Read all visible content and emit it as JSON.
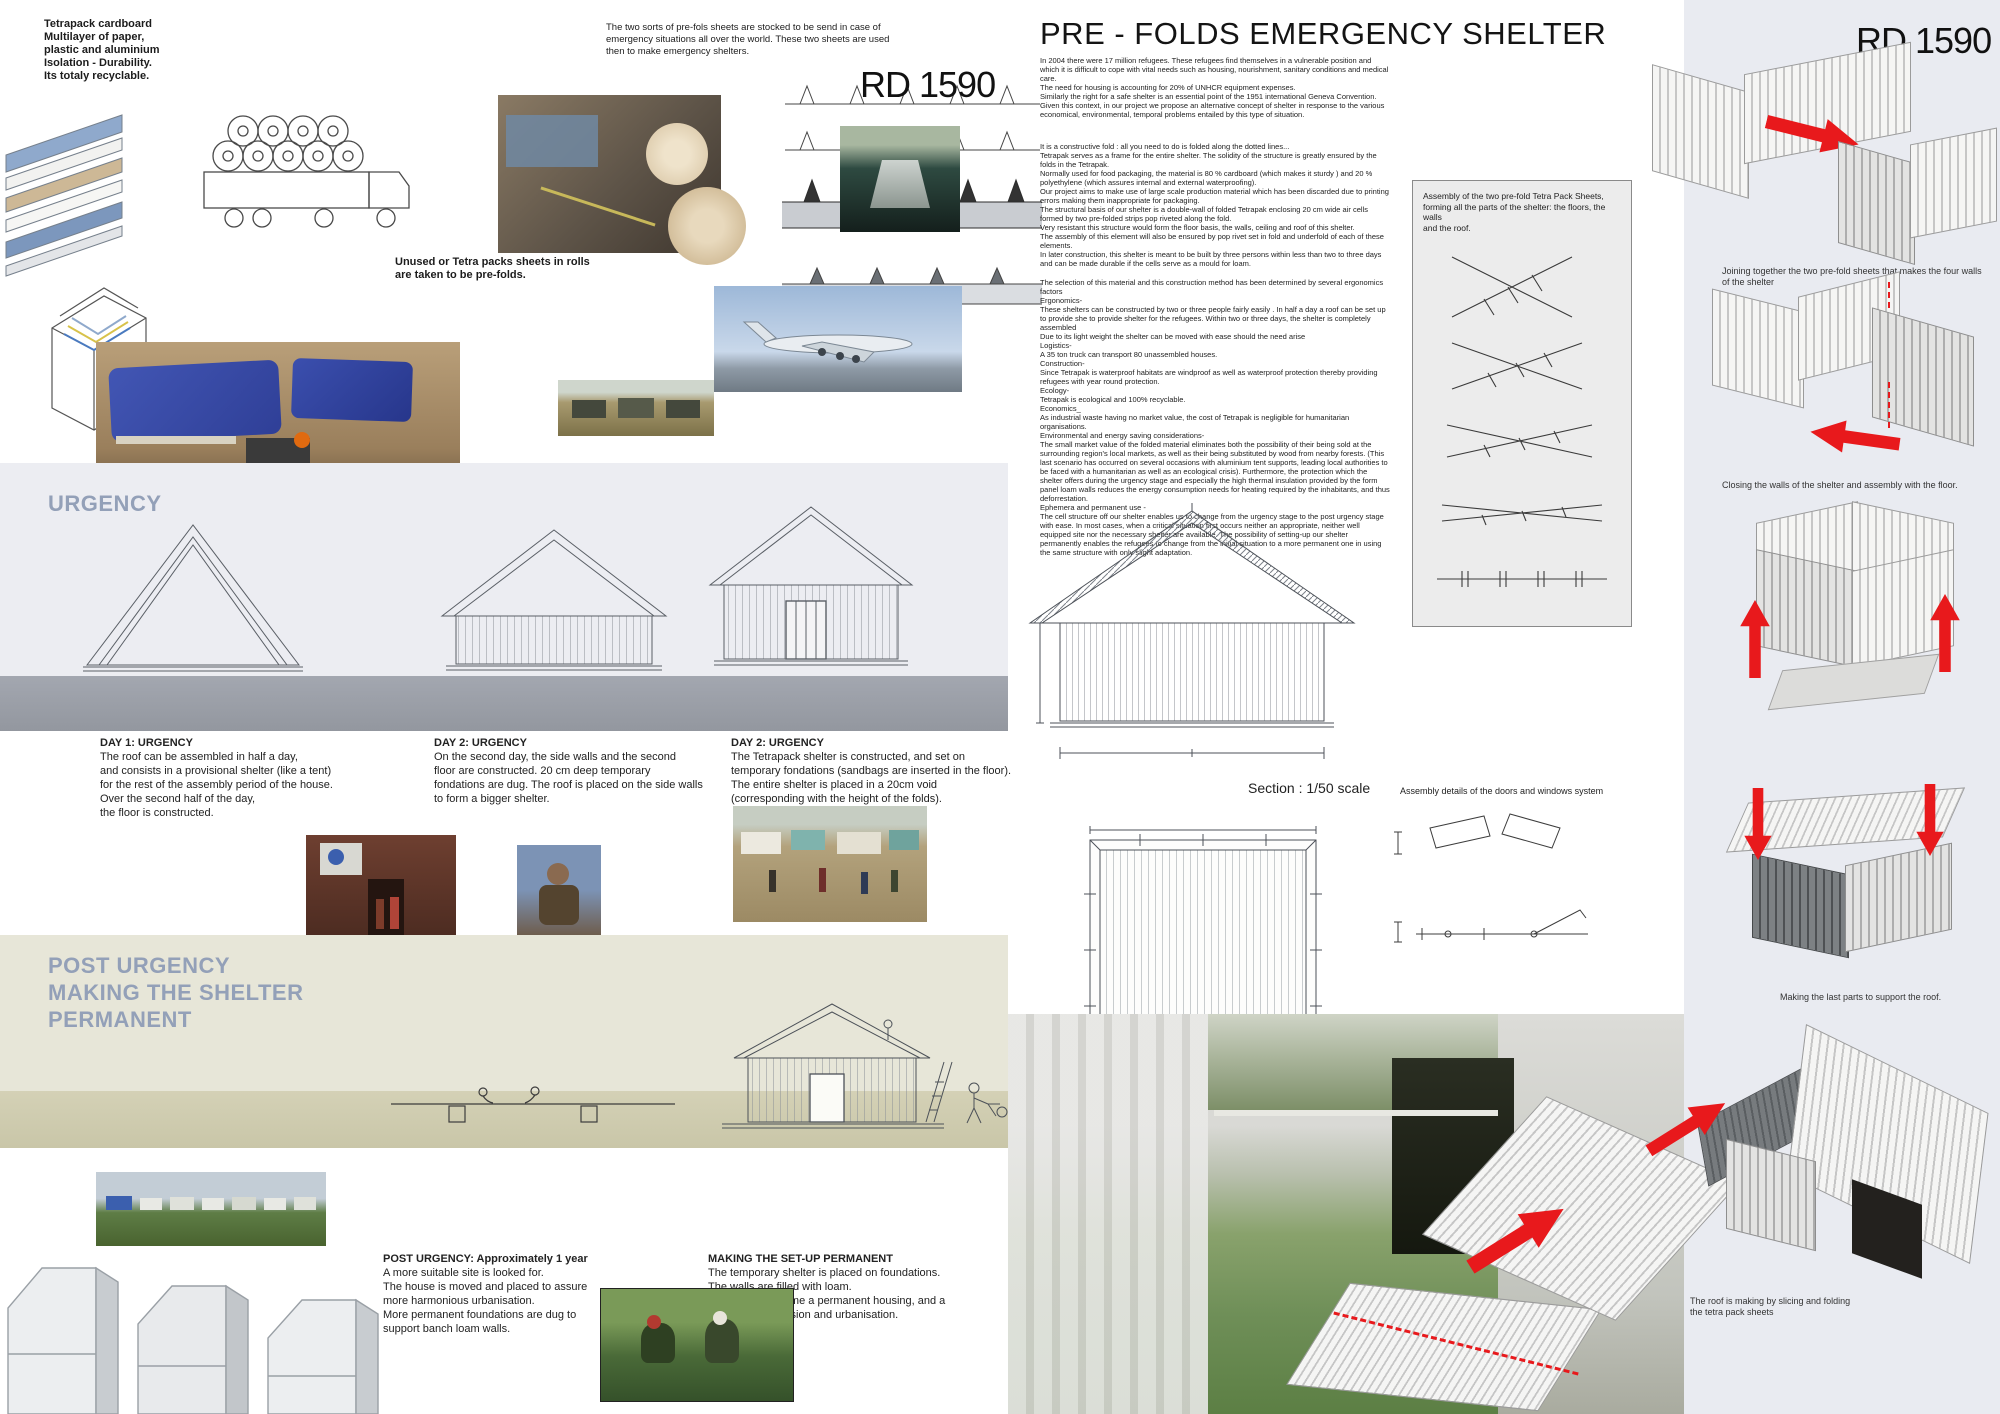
{
  "board": {
    "id": "RD 1590"
  },
  "colors": {
    "accent_red": "#e8191c",
    "heading_blue": "#93a0b8",
    "urgency_bg": "#ecedf2",
    "post_bg": "#e7e6d8"
  },
  "left": {
    "material_note": "Tetrapack cardboard\nMultilayer of paper,\nplastic and aluminium\nIsolation - Durability.\nIts totaly recyclable.",
    "intro_note": "The two sorts of pre-fols sheets are stocked to be send in case of\nemergency situations all over the world. These two sheets are used\nthen to make emergency shelters.",
    "rolls_caption": "Unused or Tetra packs sheets in rolls\nare taken to be pre-folds.",
    "urgency_heading": "URGENCY",
    "day_steps": [
      {
        "title": "DAY 1: URGENCY",
        "text": "The roof can be assembled in half a day,\nand consists in a provisional shelter (like a tent)\nfor the rest of the assembly period of the house.\nOver the second half of the day,\nthe floor is constructed."
      },
      {
        "title": "DAY 2: URGENCY",
        "text": "On the second day, the side walls and the second\nfloor are constructed. 20 cm deep temporary\nfondations are dug. The roof is placed on the side walls\nto form a bigger shelter."
      },
      {
        "title": "DAY 2: URGENCY",
        "text": "The Tetrapack shelter is constructed, and set on\ntemporary fondations (sandbags are inserted in the floor).\nThe entire shelter is placed in a 20cm void\n(corresponding with the height of the folds)."
      }
    ],
    "post_heading": "POST URGENCY\nMAKING THE SHELTER\nPERMANENT",
    "post_steps": [
      {
        "title": "POST URGENCY: Approximately 1 year",
        "text": "A more suitable site is looked for.\nThe house is moved and placed to assure\nmore harmonious urbanisation.\nMore permanent foundations are dug to\nsupport banch loam walls."
      },
      {
        "title": "MAKING THE SET-UP PERMANENT",
        "text": "The temporary shelter is placed on foundations.\nThe walls are filled with loam.\nThe shelter became a permanent housing, and a\nsupport for extension and urbanisation."
      }
    ]
  },
  "center": {
    "title": "PRE - FOLDS EMERGENCY SHELTER",
    "paragraphs": [
      "In 2004 there were 17 million refugees. These refugees find themselves in a vulnerable position and which it is difficult to cope with vital needs such as housing, nourishment, sanitary conditions and medical care.\nThe need for housing is accounting for 20% of UNHCR equipment expenses.\nSimilarly the right for a safe shelter is an essential point of the 1951 international Geneva Convention.\nGiven this context, in our project we propose an alternative concept of shelter in response to the various economical, environmental, temporal problems entailed by this type of situation.",
      "It is a constructive fold : all you need to do is folded along the dotted lines...\nTetrapak serves as a frame for the entire shelter. The solidity of the structure is greatly ensured by the folds in the Tetrapak.\nNormally used for food packaging, the material is 80 % cardboard (which makes it sturdy ) and 20 % polyethylene (which assures internal and external waterproofing).\nOur project aims to make use of large scale production material which has been discarded due to printing errors making them inappropriate for packaging.\nThe structural basis of our shelter is a double-wall of folded Tetrapak enclosing 20 cm wide air cells formed by two pre-folded strips pop riveted along the fold.\nVery resistant this structure would form the floor basis, the walls, ceiling and roof of this shelter.\nThe assembly of this element will also be ensured by pop rivet set in fold and underfold of each of these elements.\nIn later construction, this shelter is meant to be built by three persons within less than two to three days and can be made durable if the cells serve as a mould for loam.",
      "The selection of this material and this construction method has been determined by several ergonomics factors\nErgonomics-\nThese shelters can be constructed by two or three people fairly easily . In half a day a roof can be set up to provide she to provide shelter for the refugees. Within two or three days, the shelter is completely assembled\nDue to its light weight the shelter can be moved with ease should the need arise\nLogistics-\nA 35 ton truck can transport 80 unassembled houses.\nConstruction-\nSince Tetrapak is waterproof  habitats are windproof as well as waterproof protection thereby providing refugees with year round protection.\nEcology-\nTetrapak is ecological and 100% recyclable.\nEconomics_\nAs industrial waste having no market value, the cost of Tetrapak is negligible for humanitarian organisations.\nEnvironmental and energy saving considerations-\nThe small market value of the folded material eliminates both the possibility of their being sold at the surrounding region's local markets, as well as their being substituted by wood from nearby forests. (This last scenario has occurred on several occasions with aluminium tent supports, leading local authorities to be faced with a humanitarian as well as an ecological crisis). Furthermore, the protection which the shelter offers during the urgency stage and especially the high thermal insulation provided by the form panel loam walls reduces the energy consumption needs for heating required by the inhabitants, and thus deforrestation.\nEphemera and permanent use -\nThe cell structure off our shelter enables us to change from the urgency stage to the post urgency stage with ease. In most cases, when a critical situation first occurs neither an appropriate, neither well equipped site nor the necessary shelter are available. The possibility of setting-up our shelter permanently enables the refugees to change from the initial situation to a more permanent one in using the same structure with only slight adaptation."
    ],
    "assembly_note": "Assembly of the two pre-fold Tetra Pack Sheets,\nforming all the parts of the shelter: the floors, the walls\nand the roof.",
    "section_label": "Section : 1/50 scale",
    "details_label": "Assembly details of the doors and windows system",
    "plan_label": "Plan : 1/50 scale"
  },
  "right": {
    "step_captions": [
      "Joining together the two pre-fold sheets that makes the four walls of the shelter",
      "Closing the walls of the shelter and assembly with the floor.",
      "Making the last parts to support the roof.",
      "The roof is making by slicing and folding\nthe tetra pack sheets"
    ]
  }
}
